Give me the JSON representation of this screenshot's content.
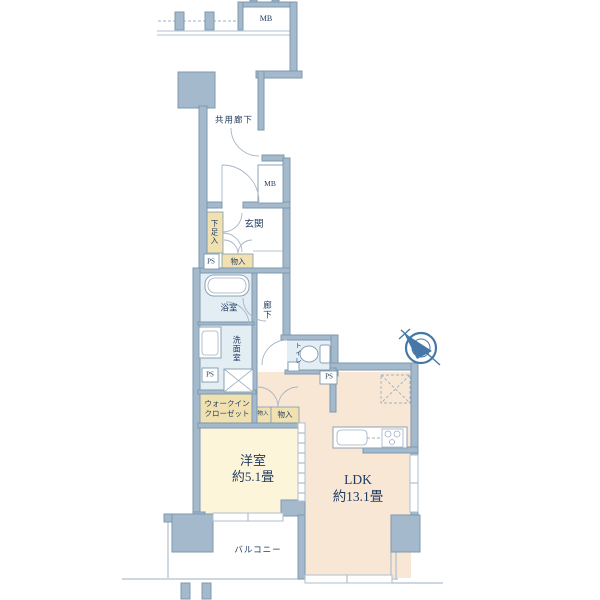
{
  "floorplan": {
    "labels": {
      "mb_top": "MB",
      "common_corridor": "共用廊下",
      "mb_mid": "MB",
      "entrance": "玄関",
      "shoe_cabinet": "下足入",
      "ps_entry": "PS",
      "storage_entry": "物入",
      "bathroom": "浴室",
      "hallway": "廊下",
      "washroom": "洗面室",
      "toilet": "トイレ",
      "ps_washroom": "PS",
      "ps_toilet": "PS",
      "wic_line1": "ウォークイン",
      "wic_line2": "クローゼット",
      "storage_hall_small": "物入",
      "storage_hall": "物入",
      "western_room_name": "洋室",
      "western_room_size": "約5.1畳",
      "ldk_name": "LDK",
      "ldk_size": "約13.1畳",
      "balcony": "バルコニー"
    },
    "icons": {
      "compass": "north-compass-icon"
    },
    "colors": {
      "wall": "#a4bacc",
      "wall_border": "#7e98ae",
      "room_cream": "#fcf5da",
      "room_pink": "#f9e7d6",
      "room_blue": "#e3edf4",
      "closet_yellow": "#f1e1b0",
      "line": "#b0bfcc",
      "text": "#1e3a5f",
      "compass": "#4578a8"
    }
  }
}
